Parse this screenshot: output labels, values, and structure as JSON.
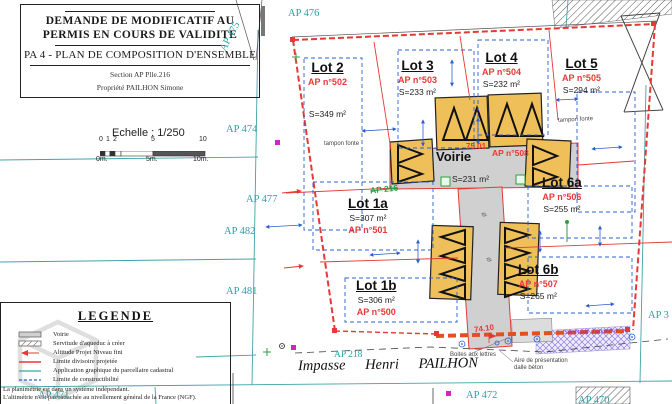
{
  "document": {
    "title_line1": "DEMANDE DE MODIFICATIF AU",
    "title_line2": "PERMIS EN COURS DE VALIDITE",
    "subtitle": "PA 4 - PLAN DE COMPOSITION D'ENSEMBLE",
    "section": "Section AP Plle.216",
    "owner": "Propriété PAILHON Simone"
  },
  "scale": {
    "label": "Echelle : 1/250",
    "ticks_top": [
      "0",
      "1",
      "2",
      "5",
      "10"
    ],
    "ticks_bottom": [
      "0m.",
      "5m.",
      "10m."
    ]
  },
  "legend": {
    "title": "LEGENDE",
    "items": [
      {
        "label": "Voirie"
      },
      {
        "label": "Servitude d'aqueduc à créer"
      },
      {
        "label": "Altitude Projet Niveau fini"
      },
      {
        "label": "Limite divisoire projetée"
      },
      {
        "label": "Application graphique du parcellaire cadastral"
      },
      {
        "label": "Limite de constructibilité"
      }
    ],
    "notes": [
      "La planimétrie est dans un système indépendant.",
      "L'altimétrie n'est pas rattachée au nivellement général de la France (NGF)."
    ]
  },
  "parcels": {
    "ap476": "AP 476",
    "ap475": "AP 475",
    "ap474": "AP 474",
    "ap477": "AP 477",
    "ap482": "AP 482",
    "ap481": "AP 481",
    "ap218": "AP 218",
    "ap471": "AP 471",
    "ap472": "AP 472",
    "ap470": "AP 470",
    "ap3": "AP 3",
    "ap216_old": "AP 216"
  },
  "lots": [
    {
      "name": "Lot 2",
      "ap": "AP n°502",
      "area": "S=349 m²"
    },
    {
      "name": "Lot 3",
      "ap": "AP n°503",
      "area": "S=233 m²"
    },
    {
      "name": "Lot 4",
      "ap": "AP n°504",
      "area": "S=232 m²"
    },
    {
      "name": "Lot 5",
      "ap": "AP n°505",
      "area": "S=294 m²"
    },
    {
      "name": "Lot 1a",
      "ap": "AP n°501",
      "area": "S=307 m²"
    },
    {
      "name": "Lot 1b",
      "ap": "AP n°500",
      "area": "S=306 m²"
    },
    {
      "name": "Lot 6a",
      "ap": "AP n°506",
      "area": "S=255 m²"
    },
    {
      "name": "Lot 6b",
      "ap": "AP n°507",
      "area": "S=265 m²"
    }
  ],
  "voirie": {
    "label": "Voirie",
    "ap": "AP n°508",
    "area": "S=231 m²",
    "elevation": "75.01"
  },
  "street": {
    "name": "Impasse Henri PAILHON"
  },
  "annotations": {
    "tampon_fonte": "tampon fonte",
    "boites": "Boites aux lettres",
    "aire_line1": "Aire de présentation",
    "aire_line2": "dalle béton",
    "servitude": "Servitude d'aqueduc",
    "elev": "74.10",
    "diameter": "ø"
  },
  "colors": {
    "cadastral_teal": "#2E9FA4",
    "boundary_red": "#E53935",
    "boundary_orange": "#E05020",
    "dimension_blue": "#2B5FD0",
    "building_yellow": "#EFC05A",
    "road_gray": "#D0D0D0",
    "project_green": "#2F9E44",
    "servitude_purple": "#8B2FC9"
  }
}
